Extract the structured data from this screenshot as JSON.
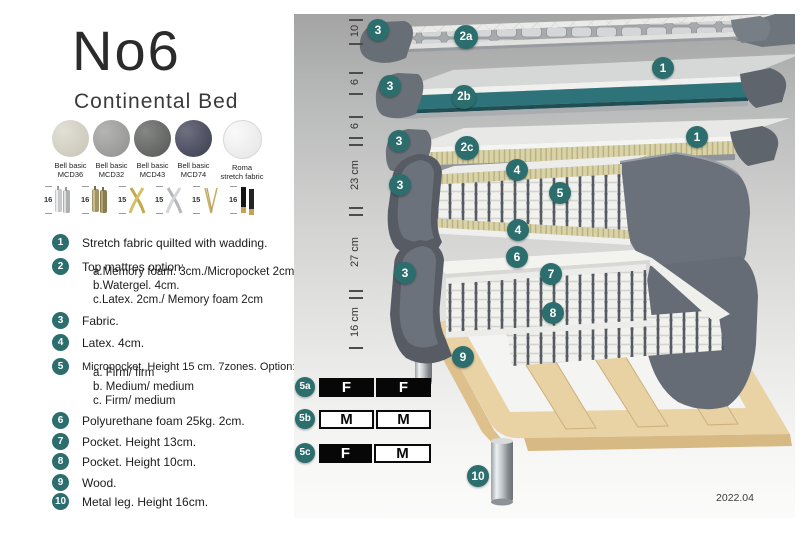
{
  "title": "No6",
  "subtitle": "Continental Bed",
  "swatches": [
    {
      "name": "Bell basic",
      "code": "MCD36",
      "color": "#d8d4c6"
    },
    {
      "name": "Bell basic",
      "code": "MCD32",
      "color": "#9c9c9a"
    },
    {
      "name": "Bell basic",
      "code": "MCD43",
      "color": "#5c5e5c"
    },
    {
      "name": "Bell basic",
      "code": "MCD74",
      "color": "#3e4156"
    },
    {
      "name": "Roma",
      "code": "stretch fabric",
      "color": "#f8f8f8"
    }
  ],
  "legs": [
    {
      "height": "16",
      "style": "cylinder-chrome"
    },
    {
      "height": "16",
      "style": "cylinder-brass"
    },
    {
      "height": "15",
      "style": "cross-gold"
    },
    {
      "height": "15",
      "style": "cross-silver"
    },
    {
      "height": "15",
      "style": "hairpin-gold"
    },
    {
      "height": "16",
      "style": "block-black-gold"
    }
  ],
  "list": {
    "items": [
      {
        "num": "1",
        "text": "Stretch fabric quilted with wadding."
      },
      {
        "num": "2",
        "text": "Top mattres option:",
        "subs": [
          "a.Memory foam. 3cm./Micropocket 2cm",
          "b.Watergel. 4cm.",
          "c.Latex. 2cm./ Memory foam 2cm"
        ]
      },
      {
        "num": "3",
        "text": "Fabric."
      },
      {
        "num": "4",
        "text": "Latex. 4cm."
      },
      {
        "num": "5",
        "text": "Micropocket. Height 15 cm. 7zones. Option:",
        "subs": [
          "a. Firm/ firm",
          "b. Medium/ medium",
          "c. Firm/ medium"
        ]
      },
      {
        "num": "6",
        "text": "Polyurethane foam 25kg. 2cm."
      },
      {
        "num": "7",
        "text": "Pocket. Height 13cm."
      },
      {
        "num": "8",
        "text": "Pocket. Height 10cm."
      },
      {
        "num": "9",
        "text": "Wood."
      },
      {
        "num": "10",
        "text": "Metal leg. Height 16cm."
      }
    ]
  },
  "diagram": {
    "scale": [
      {
        "label": "10"
      },
      {
        "label": "6"
      },
      {
        "label": "6"
      },
      {
        "label": "23 cm"
      },
      {
        "label": "27 cm"
      },
      {
        "label": "16 cm"
      }
    ],
    "badges": [
      {
        "label": "3"
      },
      {
        "label": "2a"
      },
      {
        "label": "1"
      },
      {
        "label": "3"
      },
      {
        "label": "2b"
      },
      {
        "label": "1"
      },
      {
        "label": "3"
      },
      {
        "label": "2c"
      },
      {
        "label": "4"
      },
      {
        "label": "3"
      },
      {
        "label": "5"
      },
      {
        "label": "4"
      },
      {
        "label": "6"
      },
      {
        "label": "3"
      },
      {
        "label": "7"
      },
      {
        "label": "8"
      },
      {
        "label": "9"
      },
      {
        "label": "10"
      }
    ],
    "firmness": {
      "rows": [
        {
          "badge": "5a",
          "cells": [
            {
              "v": "F",
              "tone": "dark"
            },
            {
              "v": "F",
              "tone": "dark"
            }
          ]
        },
        {
          "badge": "5b",
          "cells": [
            {
              "v": "M",
              "tone": "light"
            },
            {
              "v": "M",
              "tone": "light"
            }
          ]
        },
        {
          "badge": "5c",
          "cells": [
            {
              "v": "F",
              "tone": "dark"
            },
            {
              "v": "M",
              "tone": "light"
            }
          ]
        }
      ]
    },
    "version": "2022.04",
    "colors": {
      "badge_teal": "#2c6e6e",
      "watergel_teal": "#2e737a",
      "fabric_gray": "#5d636c",
      "latex_tan": "#d9d3a7",
      "wood": "#e9d2a4"
    }
  }
}
